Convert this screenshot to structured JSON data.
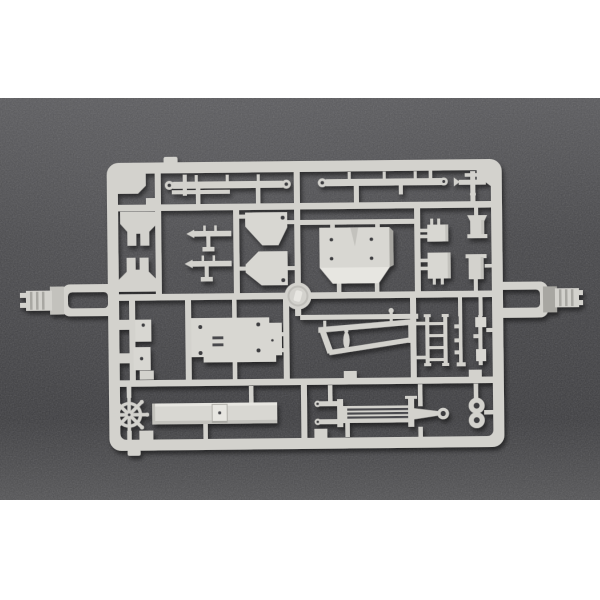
{
  "photo": {
    "subject": "injection-molded plastic model kit sprue (parts runner) photographed on dark textured background",
    "letterbox": "white bars at top and bottom",
    "sprue_material": "light grey styrene plastic"
  },
  "colors": {
    "page_bg": "#ffffff",
    "photo_top": "#5a5a5d",
    "photo_mid": "#47474a",
    "photo_low": "#3e3e41",
    "photo_bottom": "#545456",
    "sprue": "#d3d2cd",
    "sprue_light": "#e7e6e1",
    "sprue_mid": "#c3c2bd",
    "sprue_dark": "#a8a7a2",
    "plate": "#d8d7d2",
    "hole": "#3c3c40",
    "slot": "#4a4a4e",
    "shadow": "#000000"
  },
  "parts": [
    {
      "id": "sprue-frame",
      "label": "outer runner frame"
    },
    {
      "id": "left-connector-tab",
      "label": "left runner connector tab with ribbed plug"
    },
    {
      "id": "right-connector-tab",
      "label": "right runner connector tab with ribbed plug"
    },
    {
      "id": "railing-bar-left",
      "label": "long railing bar with eyelets and posts"
    },
    {
      "id": "railing-bar-right",
      "label": "long railing bar with eyelets and posts"
    },
    {
      "id": "anchor-cross-part",
      "label": "small cross/anchor shaped fitting"
    },
    {
      "id": "yoke-bracket-upper",
      "label": "notched yoke bracket"
    },
    {
      "id": "yoke-bracket-lower",
      "label": "notched yoke bracket (mirrored)"
    },
    {
      "id": "gun-mount-upper",
      "label": "small gun-mount fitting"
    },
    {
      "id": "gun-mount-lower",
      "label": "small gun-mount fitting"
    },
    {
      "id": "shield-plate-upper",
      "label": "angled shield plate with locating hole"
    },
    {
      "id": "shield-plate-lower",
      "label": "angled shield plate with locating hole"
    },
    {
      "id": "turret-roof-panel",
      "label": "large beveled superstructure panel with four holes"
    },
    {
      "id": "equipment-box-upper",
      "label": "small equipment box with pins"
    },
    {
      "id": "equipment-box-lower",
      "label": "small equipment box with pins"
    },
    {
      "id": "vent-cone-upper",
      "label": "small cowl/vent fitting"
    },
    {
      "id": "vent-cone-lower",
      "label": "small cowl/vent fitting"
    },
    {
      "id": "center-disc",
      "label": "round disc part at sprue center"
    },
    {
      "id": "hook-bracket-upper",
      "label": "L-shaped hook bracket with hole"
    },
    {
      "id": "hook-bracket-lower",
      "label": "L-shaped hook bracket with hole"
    },
    {
      "id": "hull-base-plate",
      "label": "large rectangular base plate with holes and slots"
    },
    {
      "id": "boom-assembly",
      "label": "angled boom/davit assembly with spindle"
    },
    {
      "id": "ladder-part",
      "label": "four-rung ladder"
    },
    {
      "id": "mast-detail-left",
      "label": "thin mast rod with side knobs"
    },
    {
      "id": "mast-detail-right",
      "label": "mast rod with fitted blocks"
    },
    {
      "id": "helm-wheel",
      "label": "eight-spoke ship helm wheel"
    },
    {
      "id": "deck-bar",
      "label": "long deck bar with center fitting"
    },
    {
      "id": "crane-boom",
      "label": "lattice crane boom with eyelets and ring"
    },
    {
      "id": "double-eyelet",
      "label": "stacked double eyelet part"
    }
  ]
}
